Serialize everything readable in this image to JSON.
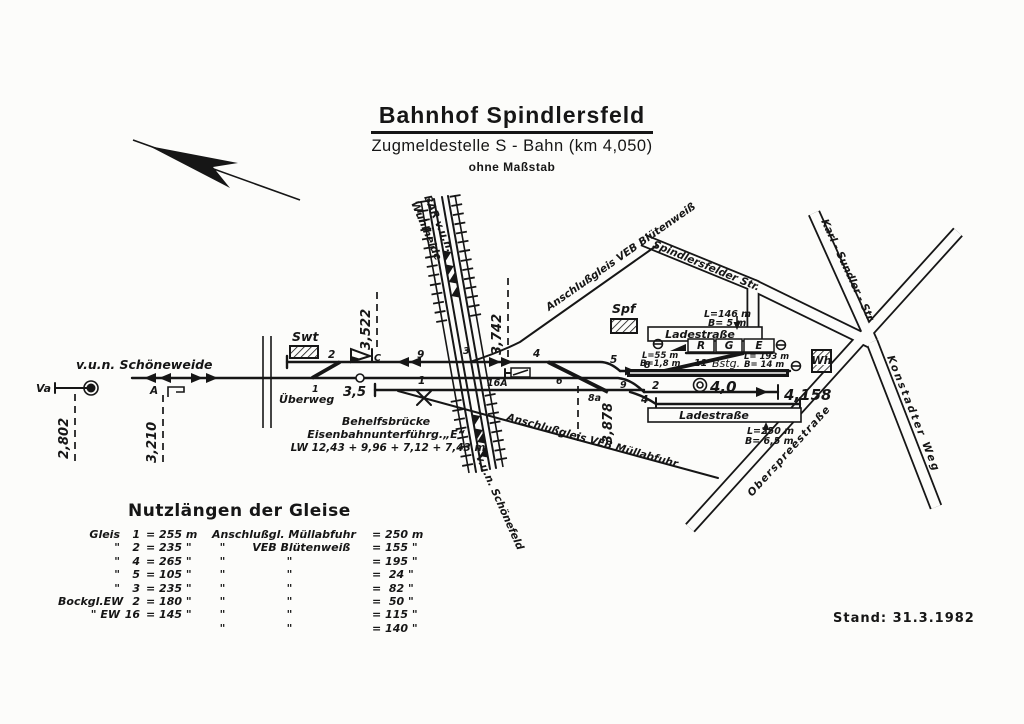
{
  "title": {
    "line1": "Bahnhof Spindlersfeld",
    "line2": "Zugmeldestelle S - Bahn (km 4,050)",
    "line3": "ohne Maßstab"
  },
  "stand": "Stand: 31.3.1982",
  "diagram": {
    "directions": {
      "schoeneweide": "v.u.n. Schöneweide",
      "bar_line1": "BAR v.u.n.",
      "bar_line2": "Wuhlheide",
      "schoenefeld": "v.u.n. Schönefeld"
    },
    "signals": {
      "va": "Va",
      "a": "A",
      "c": "C"
    },
    "km": {
      "k2802": "2,802",
      "k3210": "3,210",
      "k35": "3,5",
      "k3522": "3,522",
      "k3742": "3,742",
      "k3878": "3,878",
      "k40": "4,0",
      "k4158": "4,158"
    },
    "tracks": {
      "t1": "1",
      "t2": "2",
      "t2r": "2",
      "t4": "4",
      "t4r": "4",
      "t5": "5",
      "t8": "8",
      "t9": "9",
      "t16a": "16A",
      "sw1": "1",
      "sw3": "3",
      "sw6": "6",
      "sw8a": "8a",
      "sw9": "9",
      "sw11": "11"
    },
    "buildings": {
      "swt": "Swt",
      "spf": "Spf",
      "wh": "Wh"
    },
    "labels": {
      "ueberweg": "Überweg",
      "bstg": "Bstg.",
      "behelf1": "Behelfsbrücke",
      "behelf2": "Eisenbahnunterführg.„E“",
      "behelf3": "LW 12,43 + 9,96 + 7,12 + 7,43 m",
      "bluetenweiss": "Anschlußgleis VEB Blütenweiß",
      "muellabfuhr": "Anschlußgleis VEB Müllabfuhr",
      "ladestrasse_top": "Ladestraße",
      "ladestrasse_bottom": "Ladestraße",
      "r": "R",
      "g": "G",
      "e": "E",
      "l146": "L=146 m",
      "b5": "B= 5 m",
      "l55": "L=55 m",
      "b18": "B=1,8 m",
      "l193": "L= 193 m",
      "b14": "B= 14 m",
      "l250": "L=250 m",
      "b65": "B= 6,5 m"
    },
    "streets": {
      "spindlersfelder": "Spindlersfelder Str.",
      "karlsundler": "Karl - Sundler - Str.",
      "konstadter": "Konstadter Weg",
      "oberspree": "Oberspreestraße"
    }
  },
  "legend": {
    "title": "Nutzlängen der Gleise",
    "rows": [
      {
        "a1": "Gleis",
        "a2": "1",
        "b": "= 255 m",
        "c": "Anschlußgl. Müllabfuhr",
        "d": "= 250 m"
      },
      {
        "a1": "\"",
        "a2": "2",
        "b": "= 235 \"",
        "c": "  \"       VEB Blütenweiß",
        "d": "= 155 \""
      },
      {
        "a1": "\"",
        "a2": "4",
        "b": "= 265 \"",
        "c": "  \"                \"",
        "d": "= 195 \""
      },
      {
        "a1": "\"",
        "a2": "5",
        "b": "= 105 \"",
        "c": "  \"                \"",
        "d": "=  24 \""
      },
      {
        "a1": "\"",
        "a2": "3",
        "b": "= 235 \"",
        "c": "  \"                \"",
        "d": "=  82 \""
      },
      {
        "a1": "Bockgl.EW",
        "a2": "2",
        "b": "= 180 \"",
        "c": "  \"                \"",
        "d": "=  50 \""
      },
      {
        "a1": "\" EW",
        "a2": "16",
        "b": "= 145 \"",
        "c": "  \"                \"",
        "d": "= 115 \""
      },
      {
        "a1": "",
        "a2": "",
        "b": "",
        "c": "  \"                \"",
        "d": "= 140 \""
      }
    ]
  },
  "colors": {
    "ink": "#161616",
    "paper": "#fcfcfa"
  }
}
